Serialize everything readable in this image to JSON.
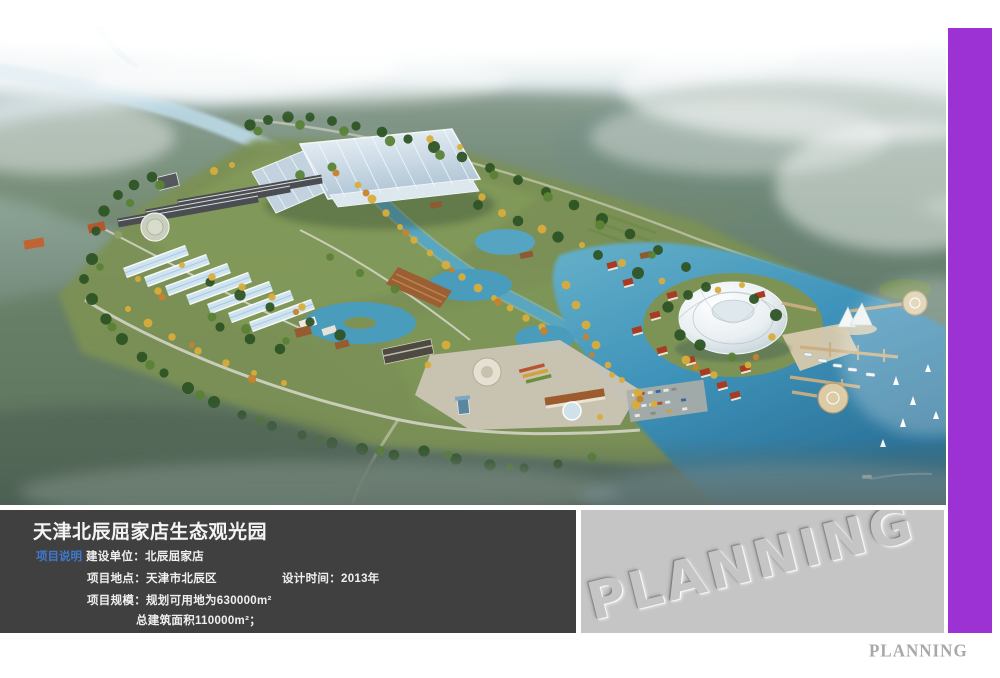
{
  "page": {
    "background": "#ffffff"
  },
  "aerial_view": {
    "colors": {
      "water": "#3f93ba",
      "canal": "#58a6c0",
      "foliage_green": "#5a8236",
      "foliage_autumn": "#d9ad3c",
      "glass_roof": "#cfdde8",
      "dome": "#eef2f4",
      "fog": "#ffffff"
    }
  },
  "info_panel": {
    "background": "#404040",
    "title": "天津北辰屈家店生态观光园",
    "section_label": "项目说明",
    "section_label_color": "#3e79cf",
    "construction_unit": "建设单位：北辰屈家店",
    "location": "项目地点：天津市北辰区",
    "design_time": "设计时间：2013年",
    "scale_line1": "项目规模：规划可用地为630000m²",
    "scale_line2": "总建筑面积110000m²；"
  },
  "watermark_panel": {
    "background": "#c5c5c5",
    "text": "PLANNING"
  },
  "side_stripe": {
    "color": "#9c31d4"
  },
  "footer": {
    "label": "PLANNING",
    "color": "#a8a8a8"
  }
}
